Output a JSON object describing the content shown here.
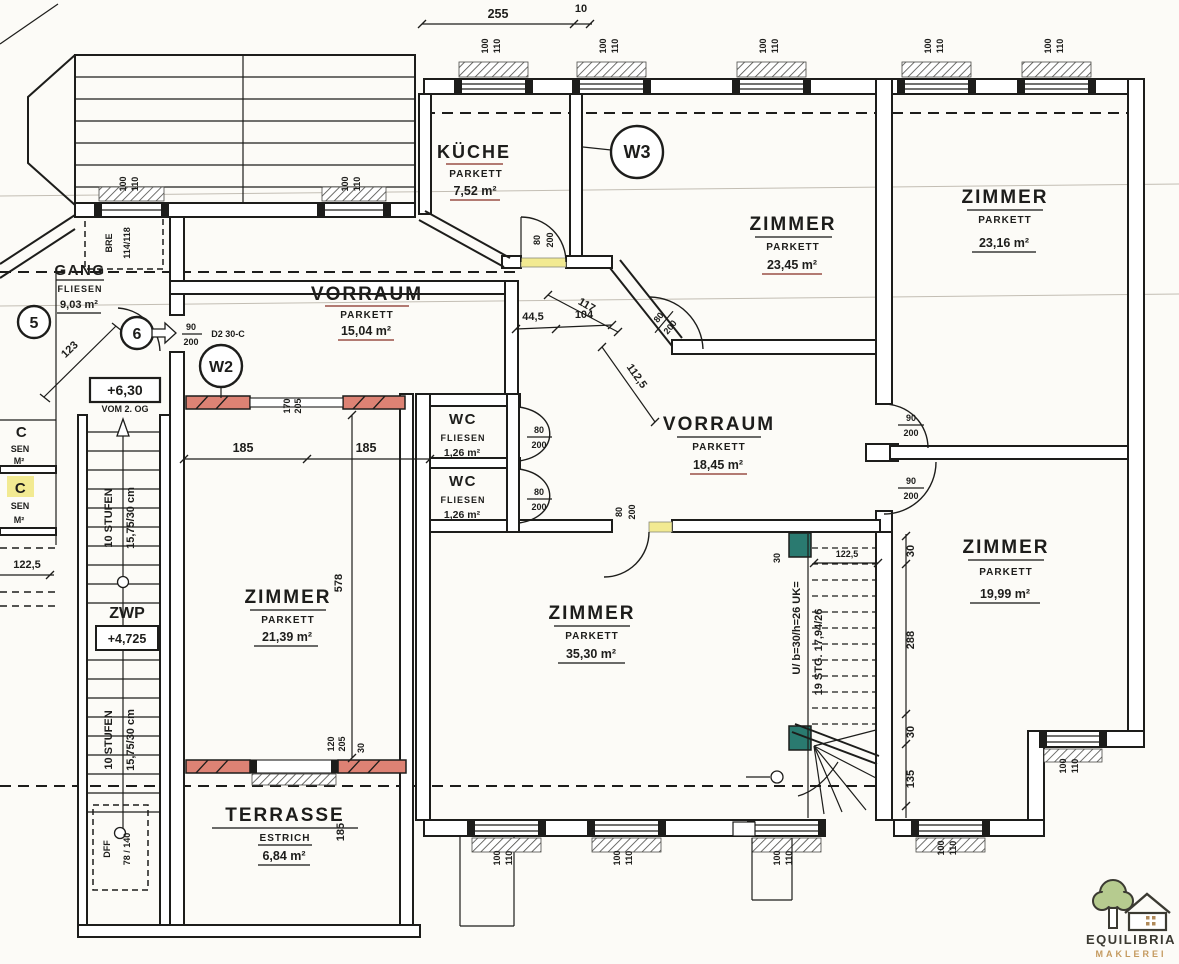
{
  "plan": {
    "rooms": [
      {
        "id": "kueche",
        "name": "KÜCHE",
        "finish": "PARKETT",
        "area": "7,52 m²"
      },
      {
        "id": "zimmer-nord",
        "name": "ZIMMER",
        "finish": "PARKETT",
        "area": "23,45 m²"
      },
      {
        "id": "zimmer-nordost",
        "name": "ZIMMER",
        "finish": "PARKETT",
        "area": "23,16 m²"
      },
      {
        "id": "gang",
        "name": "GANG",
        "finish": "FLIESEN",
        "area": "9,03 m²"
      },
      {
        "id": "vorraum-klein",
        "name": "VORRAUM",
        "finish": "PARKETT",
        "area": "15,04 m²"
      },
      {
        "id": "vorraum-gross",
        "name": "VORRAUM",
        "finish": "PARKETT",
        "area": "18,45 m²"
      },
      {
        "id": "wc-1",
        "name": "WC",
        "finish": "FLIESEN",
        "area": "1,26 m²"
      },
      {
        "id": "wc-2",
        "name": "WC",
        "finish": "FLIESEN",
        "area": "1,26 m²"
      },
      {
        "id": "zimmer-west",
        "name": "ZIMMER",
        "finish": "PARKETT",
        "area": "21,39 m²"
      },
      {
        "id": "zimmer-sued",
        "name": "ZIMMER",
        "finish": "PARKETT",
        "area": "35,30 m²"
      },
      {
        "id": "zimmer-suedost",
        "name": "ZIMMER",
        "finish": "PARKETT",
        "area": "19,99 m²"
      },
      {
        "id": "terrasse",
        "name": "TERRASSE",
        "finish": "ESTRICH",
        "area": "6,84 m²"
      }
    ],
    "markers": {
      "m5": "5",
      "m6": "6",
      "w2": "W2",
      "w3": "W3",
      "entry_door_type": "D2 30-C"
    },
    "levels": {
      "box": "+6,30",
      "from": "VOM 2. OG",
      "zwp": "ZWP",
      "zwp_level": "+4,725"
    },
    "stair_left": {
      "flight": "10 STUFEN",
      "step": "15,75/30 cm",
      "dff": "DFF",
      "dff_size": "78 / 140"
    },
    "stair_main": {
      "profile": "U/ b=30/h=26 UK=",
      "steps": "19 STG. 17,94/26"
    },
    "doors": {
      "w80": "80",
      "w90": "90",
      "h200": "200"
    },
    "windows": {
      "w": "100",
      "h": "110",
      "bre": "BRE",
      "bre_size": "114/118"
    },
    "dims": {
      "top": "255",
      "top_s": "10",
      "gang": "123",
      "split_a": "185",
      "split_b": "185",
      "room_h": "578",
      "pa": "44,5",
      "pb": "104",
      "pc": "117",
      "pd": "112,5",
      "left": "122,5",
      "stair_w": "122,5",
      "s30a": "30",
      "s288": "288",
      "s30b": "30",
      "s135": "135",
      "terrasse": "185",
      "o1w": "170",
      "o1h": "205",
      "o2w": "120",
      "o2h": "205",
      "o2off": "30"
    },
    "left_edge": {
      "c1": "C",
      "s1": "SEN",
      "a1": "M²",
      "c2": "C",
      "s2": "SEN",
      "a2": "M²"
    }
  },
  "logo": {
    "name": "EQUILIBRIA",
    "tagline": "MAKLEREI"
  },
  "colors": {
    "ink": "#1d1d1b",
    "new_wall_red": "#dd8274",
    "highlight_yellow": "#f2ea92",
    "accent_teal": "#2a7a70",
    "logo_green": "#b6cb8f",
    "logo_brown": "#3b3a32",
    "logo_gold": "#c49a5f"
  }
}
